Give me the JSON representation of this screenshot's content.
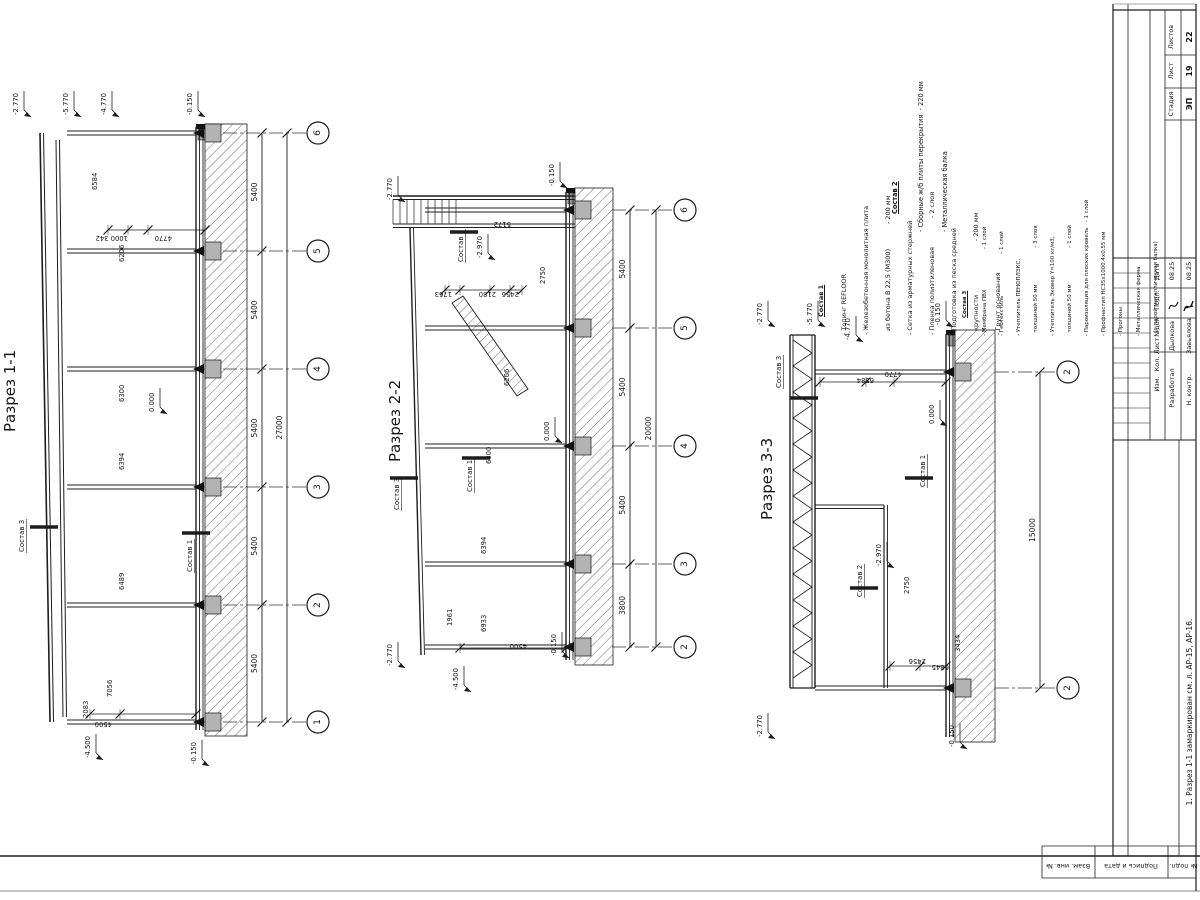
{
  "sheet": {
    "titleblock": {
      "stage_label": "Стадия",
      "stage": "ЭП",
      "sheet_label": "Лист",
      "sheet_no": "19",
      "sheets_label": "Листов",
      "sheets_total": "22",
      "cols": [
        "Изм.",
        "Кол.",
        "Лист",
        "№док",
        "Подп.",
        "Дата"
      ],
      "developed_label": "Разработал",
      "developed_name": "Дылкова",
      "checked_label": "Н. контр.",
      "checked_name": "Завьялова",
      "date1": "08.25",
      "date2": "08.25"
    },
    "note": "1. Разрез 1-1 замаркирован см. л. АР-15, АР-16.",
    "side_labels": [
      "Взам. инв. №",
      "Подпись и дата",
      "Инв. № подл."
    ]
  },
  "notes": {
    "comp1": {
      "title": "Состав 1",
      "items": [
        "- Топинг REFLOOR",
        "- Железобетонная монолитная плита",
        "  из бетона В 22,5 (М300)            - 200 мм",
        "- Сетка из арматурных стержней",
        "- Пленка полиэтиленовая              - 2 слоя",
        "- Подготовка из песка средней",
        "  крупности                          - 200 мм",
        "- Грунт основания"
      ]
    },
    "comp2": {
      "title": "Состав 2",
      "items": [
        "- Сборные ж/б плиты перекрытия  - 220 мм",
        "- Металлическая балка"
      ]
    },
    "comp3": {
      "title": "Состав 3",
      "items": [
        "- Мембрана ПВХ                       - 1 слой",
        "- Геотекстиль                        - 1 слой",
        "- Утеплитель ПЕНОПЛЭКС,",
        "  толщиной 50 мм                     - 3 слоя",
        "- Утеплитель Эковер Y=100 кг/м3,",
        "  толщиной 50 мм                     - 1 слой",
        "- Пароизоляция для плоских кровель   - 1 слой",
        "- Профнастил НС35х1000.4х0,55 мм",
        "- Прогоны",
        "- Металлическая ферма",
        "  (с парой металлическая балка)"
      ]
    }
  },
  "sections": [
    {
      "title": "Разрез 1-1",
      "axes": [
        "6",
        "5",
        "4",
        "3",
        "2",
        "1"
      ],
      "bays": [
        "5400",
        "5400",
        "5400",
        "5400",
        "5400"
      ],
      "total": "27000",
      "elevations": [
        "-2.770",
        "-5.770",
        "-4.770",
        "-0.150",
        "-4.500",
        "-0.150",
        "0.000"
      ],
      "dims": [
        "6584",
        "6206",
        "6300",
        "6394",
        "6489",
        "7056",
        "2083",
        "1000 342",
        "4770",
        "4500"
      ],
      "labels": [
        "Состав 3",
        "Состав 1"
      ]
    },
    {
      "title": "Разрез 2-2",
      "axes": [
        "6",
        "5",
        "4",
        "3",
        "2"
      ],
      "bays": [
        "5400",
        "5400",
        "5400",
        "3800"
      ],
      "total": "20000",
      "elevations": [
        "-2.770",
        "-0.150",
        "-2.770",
        "-4.500",
        "-0.150",
        "0.000",
        "-2.970"
      ],
      "dims": [
        "5172",
        "1763",
        "2180",
        "2456",
        "2750",
        "6206",
        "6300",
        "6394",
        "6933",
        "1961",
        "4500"
      ],
      "labels": [
        "Состав 2",
        "Состав 3",
        "Состав 1"
      ]
    },
    {
      "title": "Разрез 3-3",
      "axes": [
        "2",
        "2"
      ],
      "bays": [],
      "total": "15000",
      "elevations": [
        "-2.770",
        "-5.770",
        "-4.770",
        "-0.150",
        "-2.770",
        "-0.150",
        "0.000",
        "-2.970"
      ],
      "dims": [
        "6584",
        "4770",
        "2750",
        "2456",
        "6845",
        "3434"
      ],
      "labels": [
        "Состав 3",
        "Состав 1",
        "Состав 2"
      ]
    }
  ]
}
